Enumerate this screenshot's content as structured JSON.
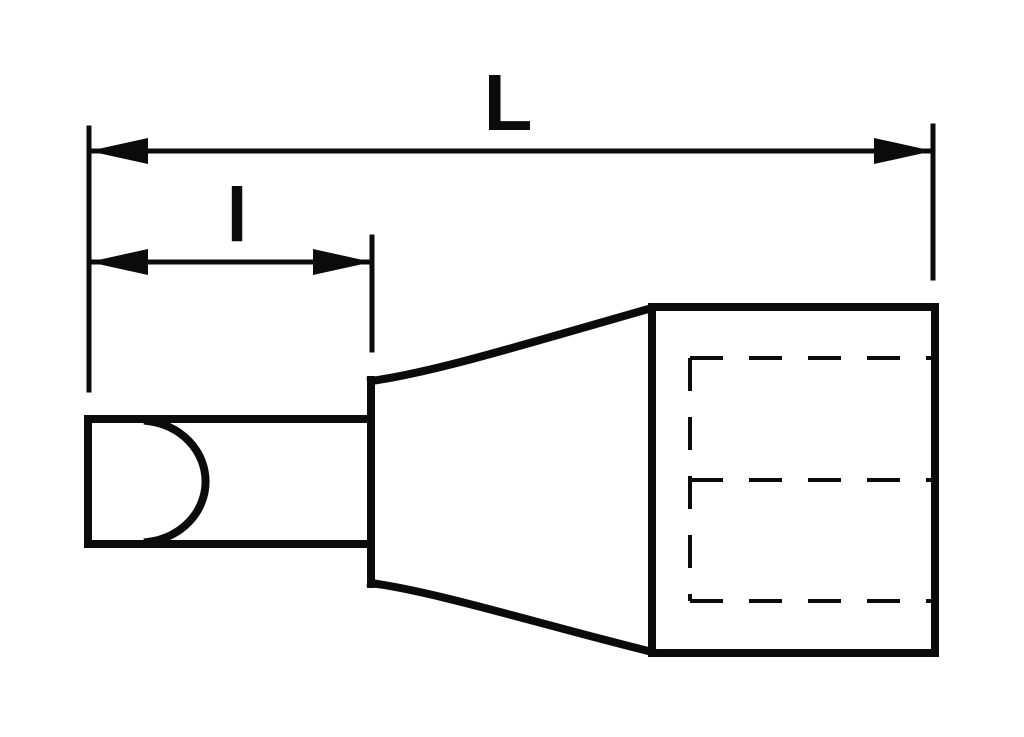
{
  "labels": {
    "overall_length": "L",
    "tip_length": "l"
  },
  "colors": {
    "ink": "#0b0b0b",
    "background": "#ffffff"
  }
}
